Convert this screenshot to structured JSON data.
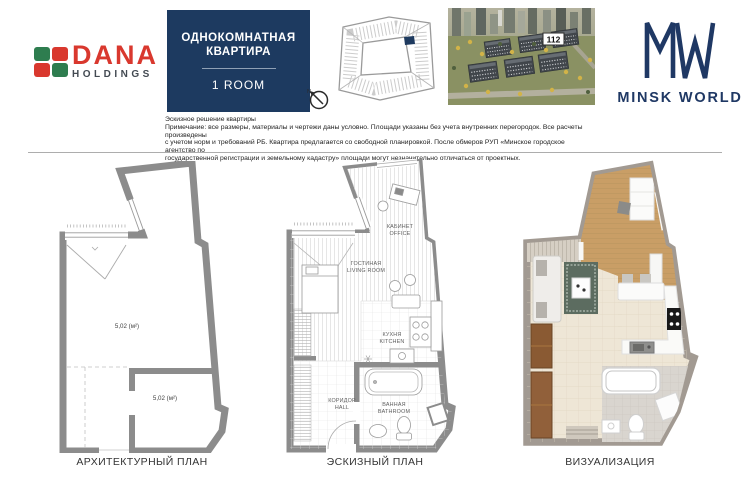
{
  "header": {
    "brand": {
      "name": "DANA",
      "holdings": "HOLDINGS"
    },
    "title": {
      "line1": "ОДНОКОМНАТНАЯ",
      "line2": "КВАРТИРА",
      "room": "1 ROOM"
    },
    "compass": {
      "north": "N"
    },
    "aerial": {
      "building_label": "112"
    },
    "mw_logo": {
      "text": "MINSK WORLD"
    },
    "note": "Эскизное решение квартиры\nПримечание: все размеры, материалы и чертежи даны условно. Площади указаны без учета внутренних перегородок. Все расчеты произведены\nс учетом норм и требований РБ. Квартира предлагается со свободной планировкой. После обмеров РУП «Минское городское агентство по\nгосударственной регистрации и земельному кадастру» площади могут незначительно отличаться от проектных."
  },
  "plans": {
    "architectural": {
      "caption": "АРХИТЕКТУРНЫЙ ПЛАН",
      "area_main": "5,02 (м²)",
      "area_secondary": "5,02 (м²)"
    },
    "sketch": {
      "caption": "ЭСКИЗНЫЙ ПЛАН",
      "rooms": [
        {
          "ru": "КАБИНЕТ",
          "en": "OFFICE"
        },
        {
          "ru": "ГОСТИНАЯ",
          "en": "LIVING ROOM"
        },
        {
          "ru": "КУХНЯ",
          "en": "KITCHEN"
        },
        {
          "ru": "КОРИДОР",
          "en": "HALL"
        },
        {
          "ru": "ВАННАЯ",
          "en": "BATHROOM"
        }
      ]
    },
    "visualization": {
      "caption": "ВИЗУАЛИЗАЦИЯ"
    }
  },
  "colors": {
    "navy": "#1d3a60",
    "brand_red": "#d9382e",
    "brand_green": "#2e7d4f",
    "wall_gray": "#8c8c8c"
  }
}
